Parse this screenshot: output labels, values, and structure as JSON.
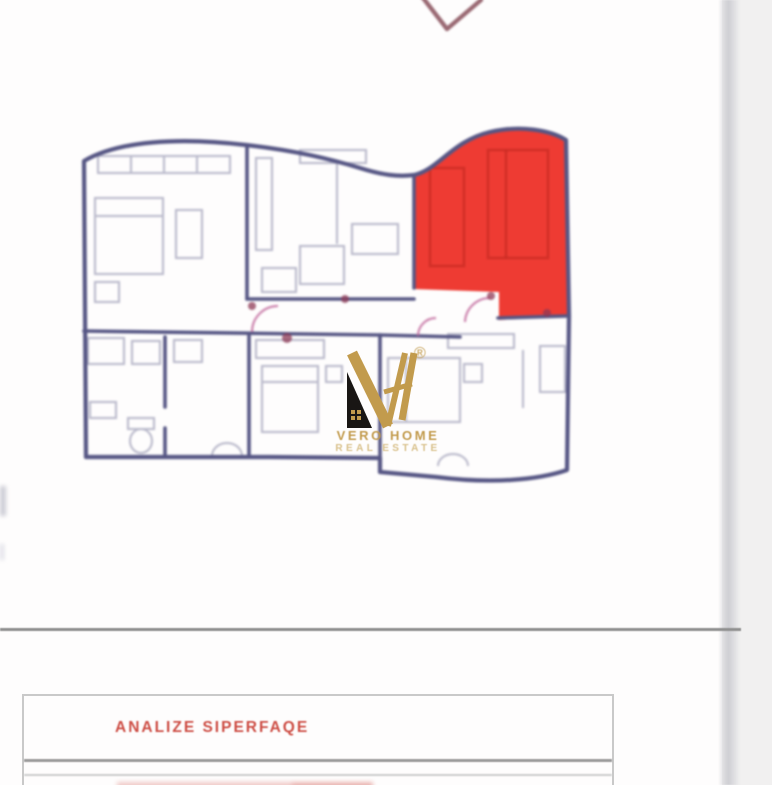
{
  "logo": {
    "name": "VERO HOME",
    "tagline": "REAL ESTATE",
    "registered_mark": "®"
  },
  "analysis_table": {
    "header": "ANALIZE SIPERFAQE"
  },
  "icons": {
    "chevron": "checkmark-chevron-partial",
    "monogram": "vh-house-monogram"
  },
  "colors": {
    "highlight-red": "#ee3b33",
    "red-furniture": "#c22a22",
    "wall-navy": "#565684",
    "furniture-gray": "#b7b7c9",
    "door-pink": "#c0679b",
    "door-maroon": "#8e3a55",
    "logo-gold": "#c29b4d",
    "logo-gold-light": "#d8c08a",
    "logo-black": "#191614",
    "header-red": "#cd4e45",
    "table-border": "#c9c9c9",
    "table-divider": "#9b9b9b",
    "rule-gray": "#8f8f8f",
    "chevron-maroon": "#8c5560",
    "page-margin-gray": "#f1f0f0"
  }
}
